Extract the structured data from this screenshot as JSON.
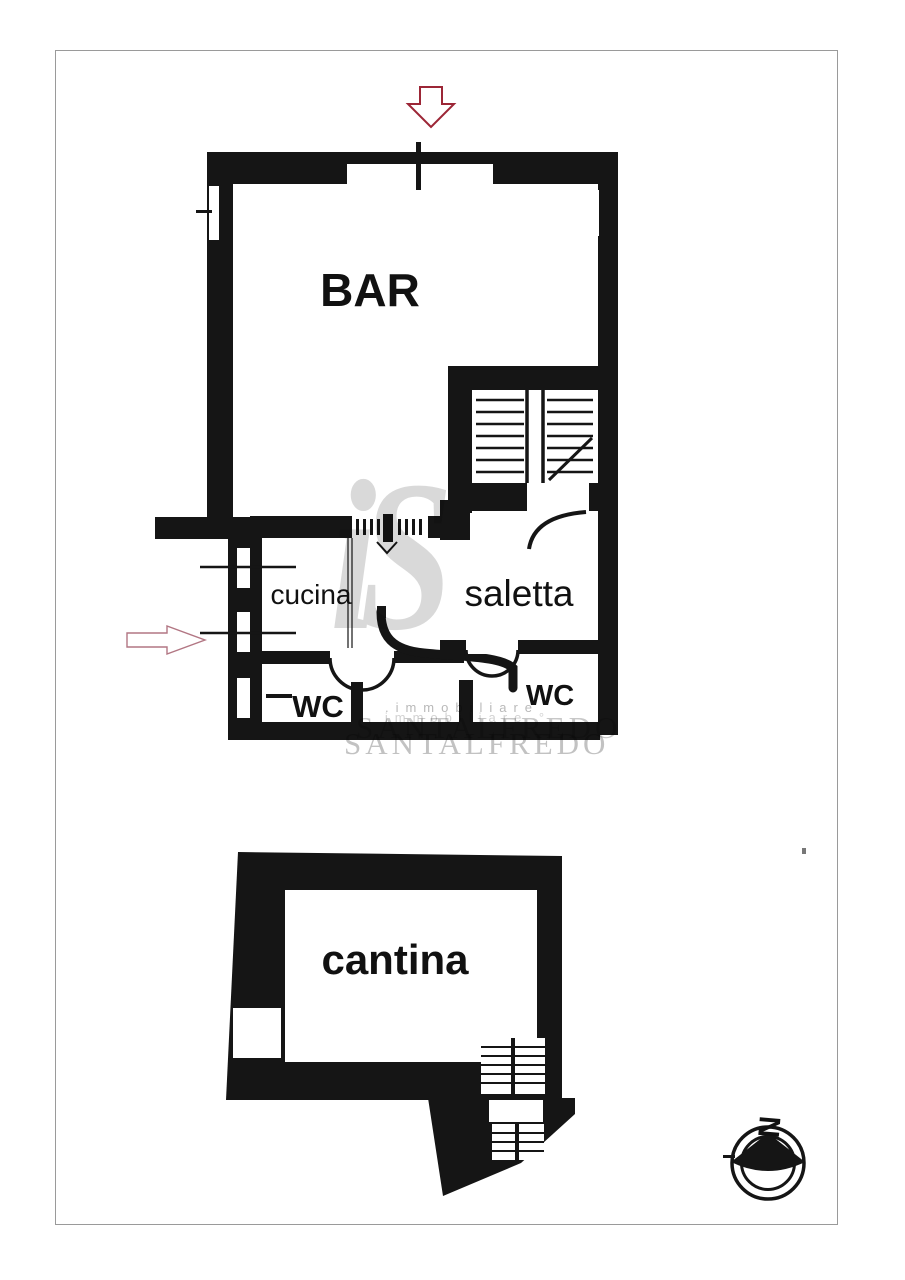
{
  "document": {
    "type": "scanned real-estate floor plan",
    "ink_color": "#151515",
    "border_color": "#9a9a9a",
    "background": "#ffffff"
  },
  "upper_plan": {
    "labels": {
      "bar": "BAR",
      "cucina": "cucina",
      "saletta": "saletta",
      "wc_left": "WC",
      "wc_right": "WC"
    },
    "entrance_arrow": {
      "direction": "down",
      "color": "#9c2636"
    },
    "side_arrow": {
      "direction": "right",
      "color": "#b27683"
    }
  },
  "lower_plan": {
    "labels": {
      "cantina": "cantina"
    }
  },
  "compass": {
    "north_label": "N"
  },
  "watermark": {
    "monogram": "iS",
    "line1": ".immobiliare",
    "line1_dup": "immobiliare °",
    "brand": "SANTALFREDO"
  }
}
